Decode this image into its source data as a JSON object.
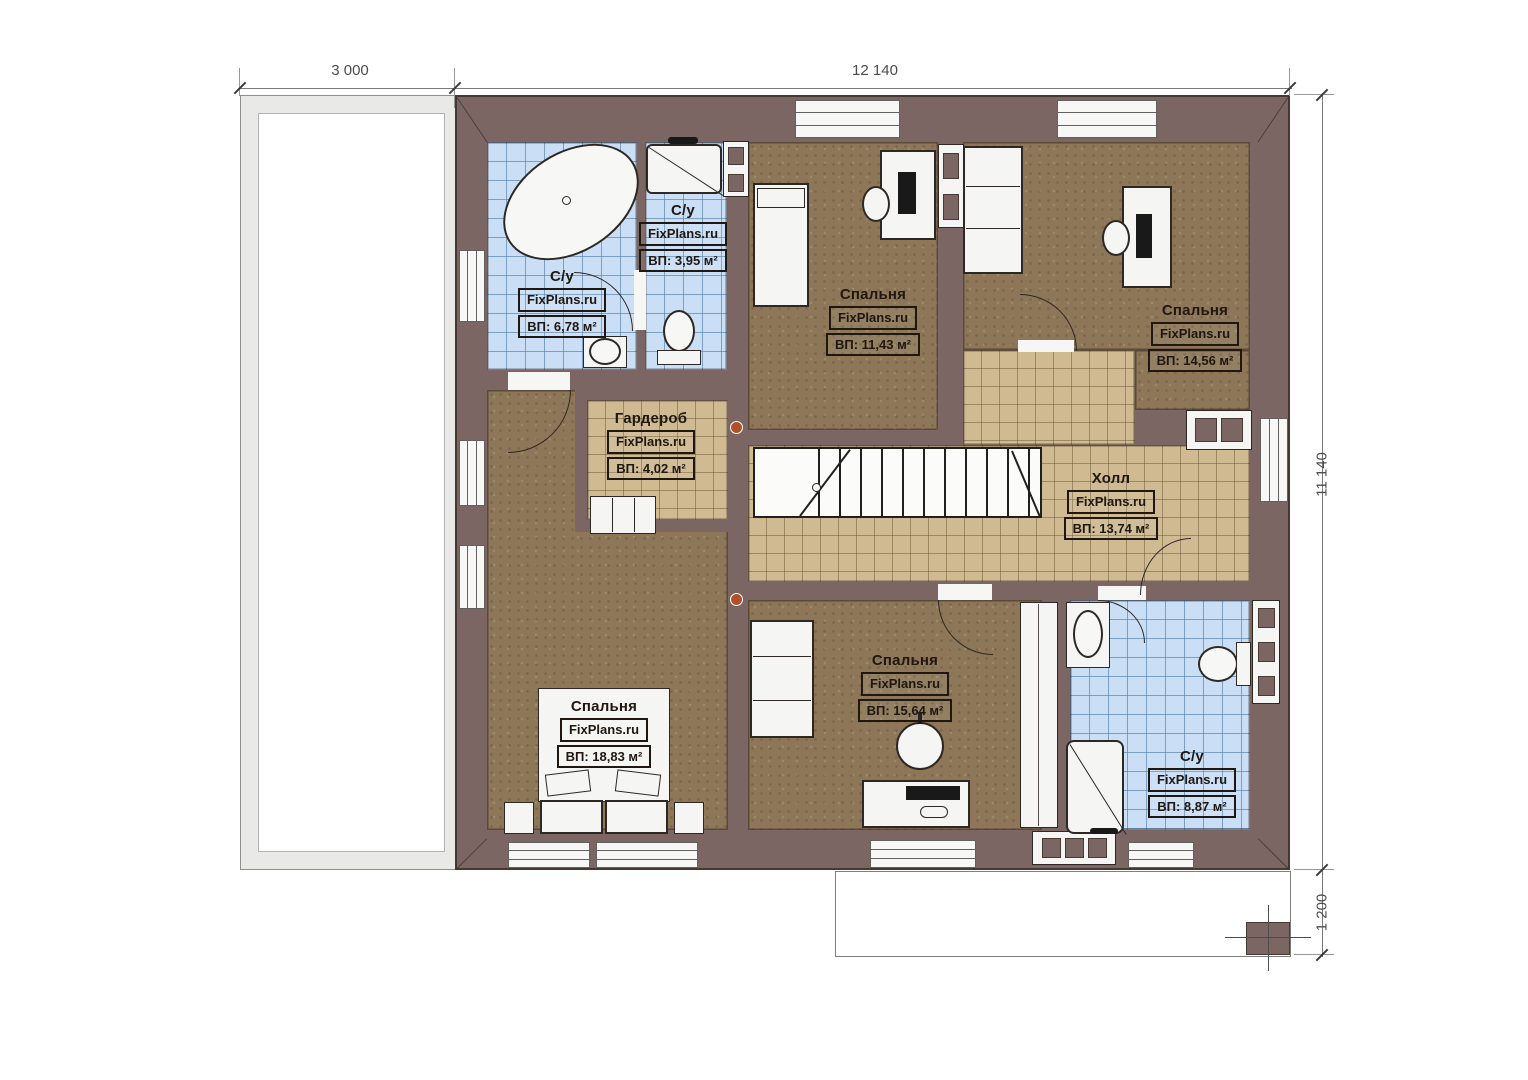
{
  "plan": {
    "brand": "FixPlans.ru",
    "dimensions": {
      "top_left": "3 000",
      "top_main": "12 140",
      "right_main": "11 140",
      "right_bottom": "1 200"
    },
    "rooms": [
      {
        "name": "С/у",
        "brand": "FixPlans.ru",
        "area": "ВП: 6,78 м²"
      },
      {
        "name": "С/у",
        "brand": "FixPlans.ru",
        "area": "ВП: 3,95 м²"
      },
      {
        "name": "Спальня",
        "brand": "FixPlans.ru",
        "area": "ВП: 11,43 м²"
      },
      {
        "name": "Спальня",
        "brand": "FixPlans.ru",
        "area": "ВП: 14,56 м²"
      },
      {
        "name": "Гардероб",
        "brand": "FixPlans.ru",
        "area": "ВП: 4,02 м²"
      },
      {
        "name": "Холл",
        "brand": "FixPlans.ru",
        "area": "ВП: 13,74 м²"
      },
      {
        "name": "Спальня",
        "brand": "FixPlans.ru",
        "area": "ВП: 18,83 м²"
      },
      {
        "name": "Спальня",
        "brand": "FixPlans.ru",
        "area": "ВП: 15,64 м²"
      },
      {
        "name": "С/у",
        "brand": "FixPlans.ru",
        "area": "ВП: 8,87 м²"
      }
    ],
    "colors": {
      "wall": "#7b6664",
      "floor_wood": "#8d7758",
      "floor_tile_blue": "#cadff5",
      "floor_tile_tan": "#cfba92",
      "furniture": "#f5f5f3"
    }
  }
}
